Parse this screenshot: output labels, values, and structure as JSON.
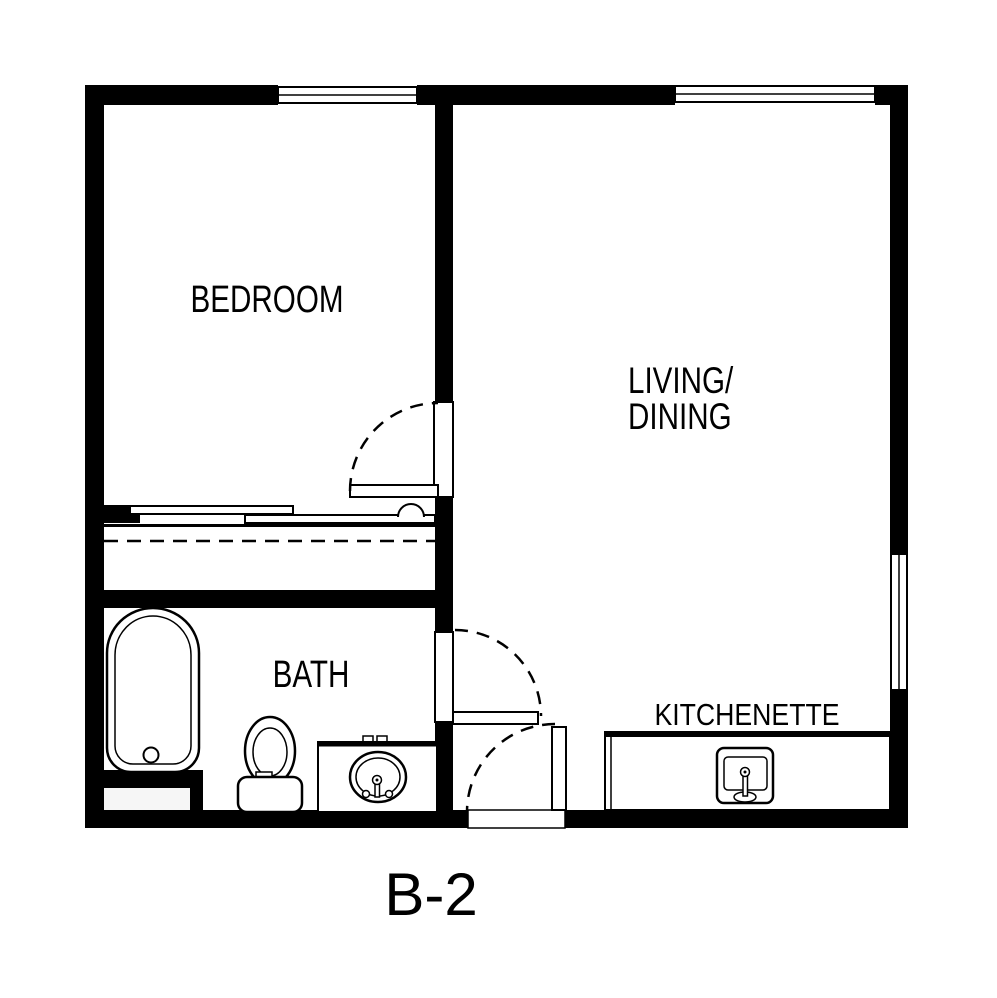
{
  "plan": {
    "unit_label": "B-2",
    "rooms": {
      "bedroom": "BEDROOM",
      "living_dining_line1": "LIVING/",
      "living_dining_line2": "DINING",
      "bath": "BATH",
      "kitchenette": "KITCHENETTE"
    },
    "colors": {
      "ink": "#000000",
      "background": "#ffffff"
    },
    "symbols": [
      "window",
      "swing-door",
      "door-swing-arc",
      "sliding-closet-doors",
      "closet-rod-dashed-line",
      "bathtub",
      "toilet",
      "vanity-sink",
      "kitchenette-counter",
      "kitchen-sink"
    ]
  }
}
